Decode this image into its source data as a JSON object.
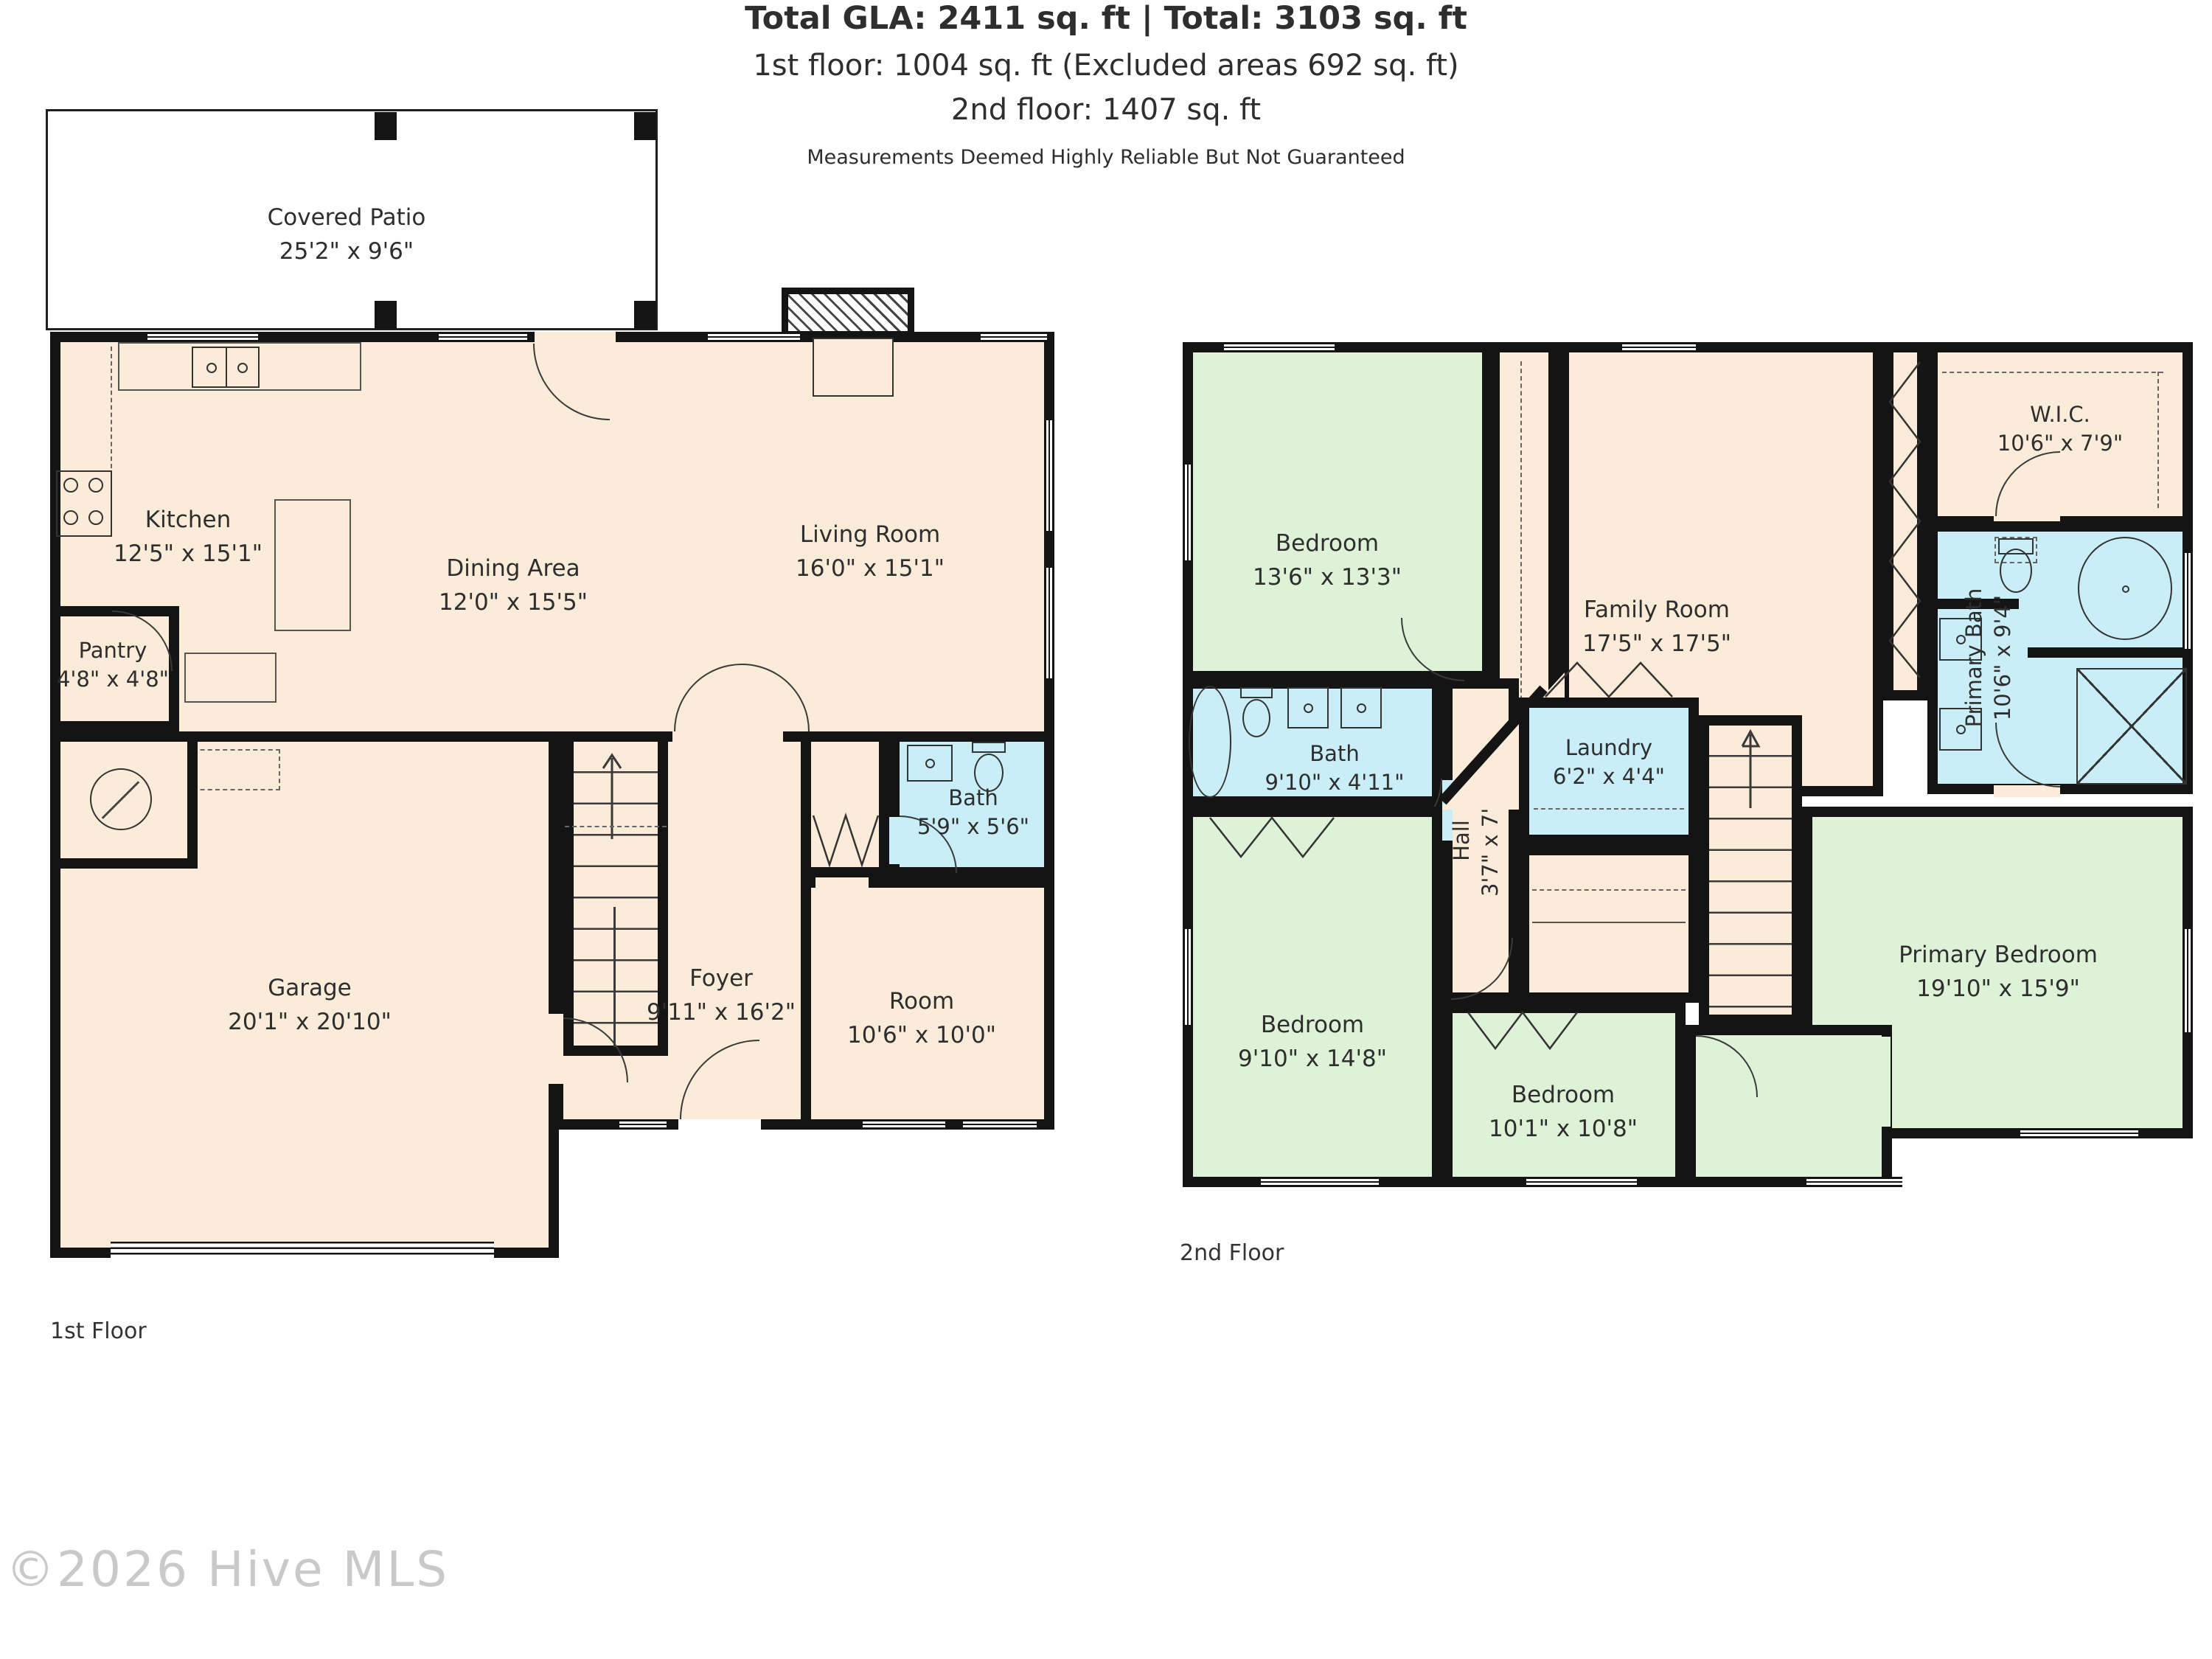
{
  "first_floor": {
    "label": "1st Floor",
    "rooms": {
      "covered_patio": {
        "name": "Covered Patio",
        "dims": "25'2\" x 9'6\""
      },
      "kitchen": {
        "name": "Kitchen",
        "dims": "12'5\" x 15'1\""
      },
      "dining": {
        "name": "Dining Area",
        "dims": "12'0\" x 15'5\""
      },
      "living": {
        "name": "Living Room",
        "dims": "16'0\" x 15'1\""
      },
      "pantry": {
        "name": "Pantry",
        "dims": "4'8\" x 4'8\""
      },
      "garage": {
        "name": "Garage",
        "dims": "20'1\" x 20'10\""
      },
      "foyer": {
        "name": "Foyer",
        "dims": "9'11\" x 16'2\""
      },
      "room": {
        "name": "Room",
        "dims": "10'6\" x 10'0\""
      },
      "bath": {
        "name": "Bath",
        "dims": "5'9\" x 5'6\""
      }
    }
  },
  "second_floor": {
    "label": "2nd Floor",
    "rooms": {
      "bedroom_1": {
        "name": "Bedroom",
        "dims": "13'6\" x 13'3\""
      },
      "family_room": {
        "name": "Family Room",
        "dims": "17'5\" x 17'5\""
      },
      "wic": {
        "name": "W.I.C.",
        "dims": "10'6\" x 7'9\""
      },
      "primary_bath": {
        "name": "Primary Bath",
        "dims": "10'6\" x 9'4\""
      },
      "bath": {
        "name": "Bath",
        "dims": "9'10\" x 4'11\""
      },
      "hall": {
        "name": "Hall",
        "dims": "3'7\" x 7'3\""
      },
      "laundry": {
        "name": "Laundry",
        "dims": "6'2\" x 4'4\""
      },
      "bedroom_2": {
        "name": "Bedroom",
        "dims": "9'10\" x 14'8\""
      },
      "bedroom_3": {
        "name": "Bedroom",
        "dims": "10'1\" x 10'8\""
      },
      "primary_bedroom": {
        "name": "Primary Bedroom",
        "dims": "19'10\" x 15'9\""
      }
    }
  },
  "summary": {
    "line1": "Total GLA: 2411 sq. ft | Total: 3103 sq. ft",
    "line2": "1st floor: 1004 sq. ft (Excluded areas 692 sq. ft)",
    "line3": "2nd floor: 1407 sq. ft",
    "disclaimer": "Measurements Deemed Highly Reliable But Not Guaranteed"
  },
  "watermark": "©2026 Hive MLS",
  "colors": {
    "floor": "#faecd8",
    "bedroom": "#def2d8",
    "bathroom": "#c9eef8",
    "wall": "#141414",
    "patio": "#ffffff"
  }
}
